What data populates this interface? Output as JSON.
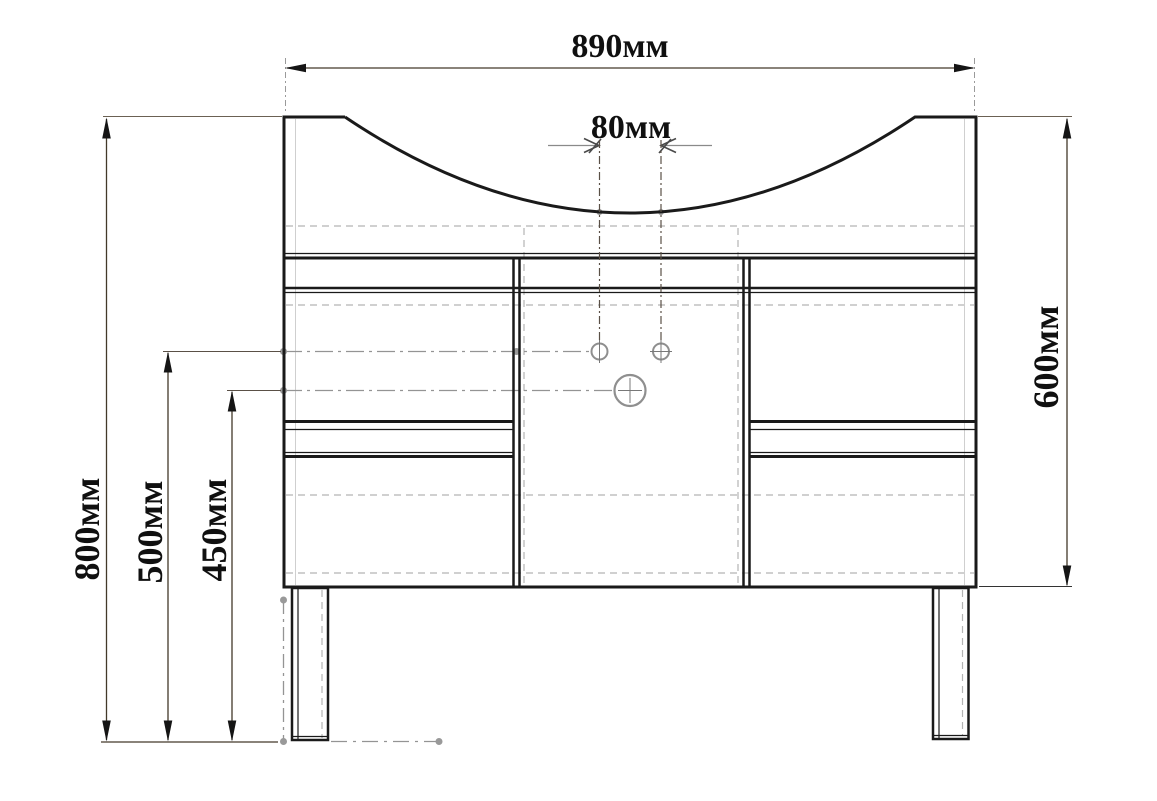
{
  "drawing": {
    "dimensions": {
      "overall_width": {
        "label": "890мм",
        "value_mm": 890
      },
      "hole_spacing": {
        "label": "80мм",
        "value_mm": 80
      },
      "cabinet_height": {
        "label": "600мм",
        "value_mm": 600
      },
      "overall_height": {
        "label": "800мм",
        "value_mm": 800
      },
      "small_holes_height": {
        "label": "500мм",
        "value_mm": 500
      },
      "large_hole_height": {
        "label": "450мм",
        "value_mm": 450
      }
    },
    "colors": {
      "object_line": "#1a1a1a",
      "dimension_line": "#43392a",
      "arrow_fill": "#151515",
      "centerline": "#949494",
      "hidden_line": "#b5b5b5",
      "hole_outline": "#8f8f8f",
      "background": "#ffffff"
    }
  }
}
